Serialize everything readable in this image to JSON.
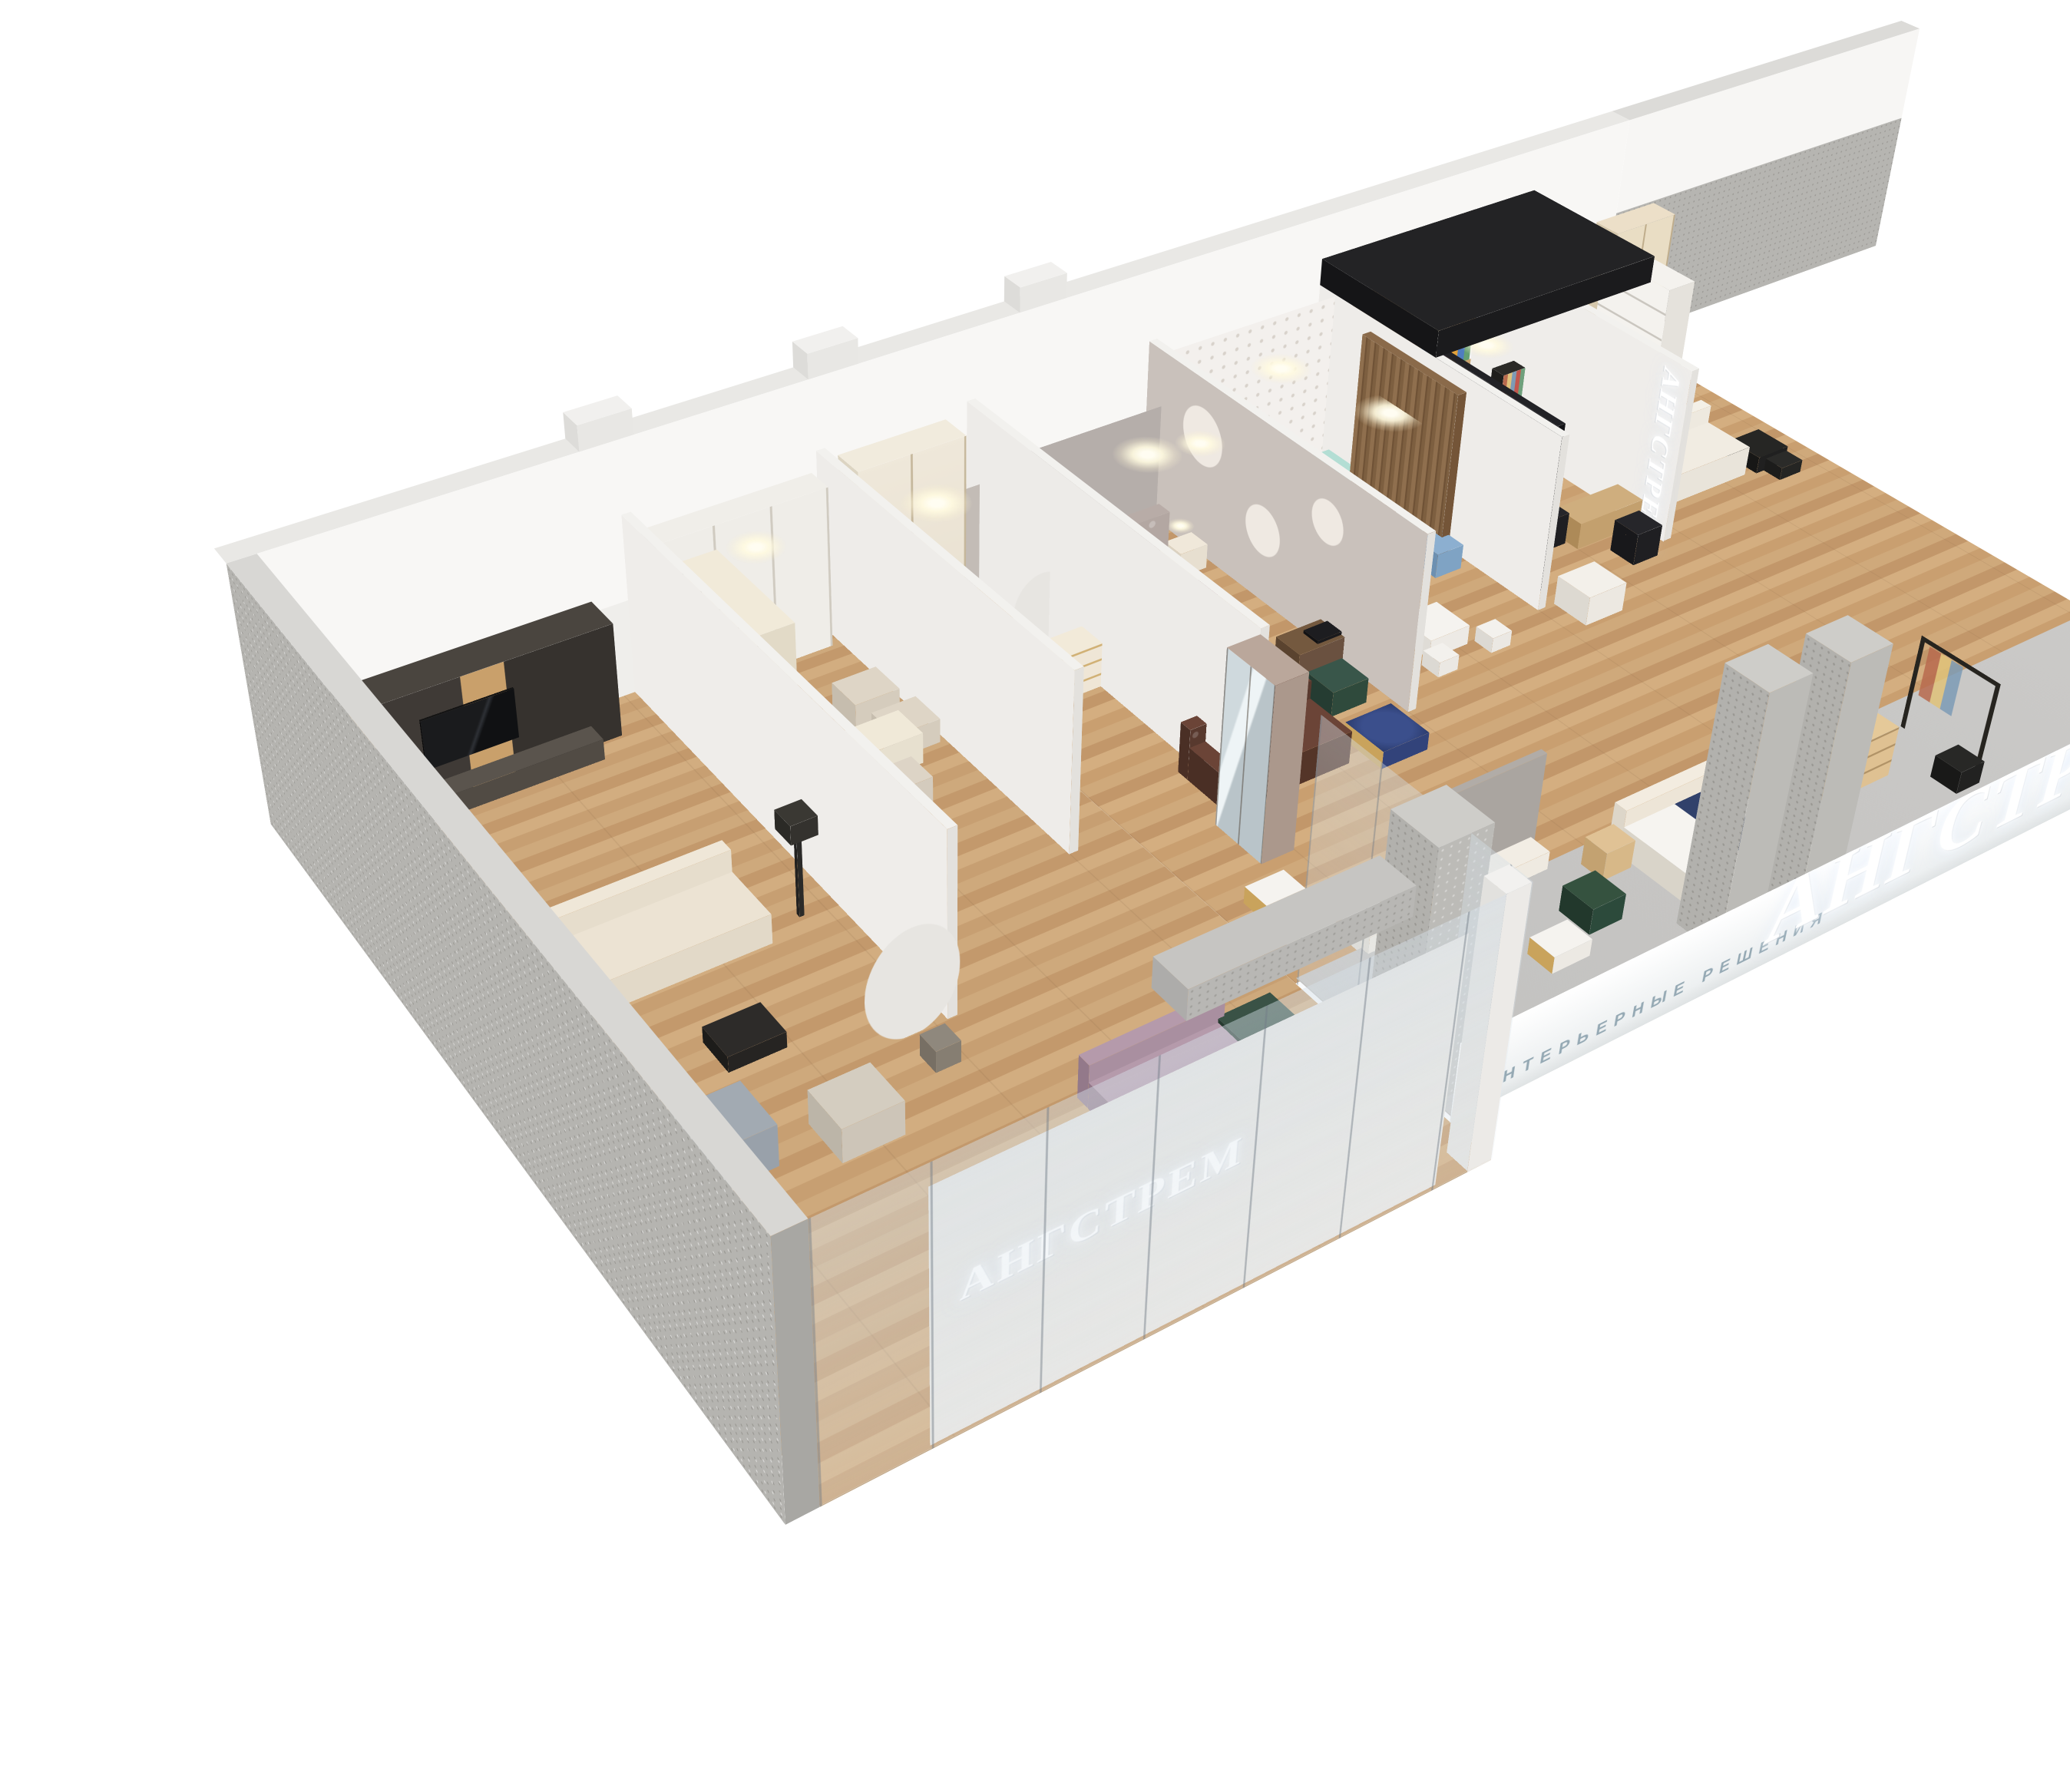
{
  "brand": {
    "name": "АНГСТРЕМ",
    "tagline": "ИНТЕРЬЕРНЫЕ РЕШЕНИЯ"
  },
  "signs": {
    "storefront_glass": "АНГСТРЕМ",
    "fascia_main": "АНГСТРЕМ",
    "fascia_tagline_left": "ИНТЕРЬЕРНЫЕ РЕШЕНИЯ",
    "fascia_tagline_right": "ИНТЕРЬЕРНЫЕ РЕШЕНИЯ",
    "fascia_tagline_far": "ИНТЕРЬЕРНЫЕ РЕШЕНИЯ",
    "interior_vertical_sign": "АНГСТРЕМ",
    "entrance_logo_icon": "angstrem-arrow-logo"
  },
  "palette": {
    "background": "#ffffff",
    "wall_white": "#f4f3f1",
    "concrete": "#b5b4b0",
    "floor_wood": "#c8a478",
    "walkway_slab": "#cbcac8",
    "glass": "rgba(213,225,232,0.28)",
    "tagline_text": "#94a8b3",
    "sign_glow": "#ffffff",
    "sofa_beige": "#e9e1d2",
    "sofa_green": "#31473c",
    "sofa_mauve": "#a98fa0",
    "chesterfield_brown": "#58392e",
    "navy_textile": "#31416b",
    "kids_mint": "#cfe3da",
    "wood_furniture": "#c9a36c",
    "dark_panel": "#1b1b1e",
    "gold": "#c9a35c"
  },
  "scene": {
    "type": "isometric-cutaway-3d-render",
    "subject": "АНГСТРЕМ furniture showroom interior",
    "areas": [
      {
        "name": "living-room-display",
        "items": [
          "tv-wall-unit",
          "tv",
          "beige-sofa",
          "floor-lamp",
          "black-nesting-coffee-tables",
          "gray-armchair",
          "patterned-wing-chair",
          "potted-tree",
          "mauve-chaise-sofa",
          "green-corner-sofa",
          "white-chairs",
          "marble-coffee-table"
        ]
      },
      {
        "name": "classic-study-display",
        "items": [
          "white-built-in",
          "glazed-bookcase",
          "writing-desk",
          "upholstered-chairs",
          "side-cabinet"
        ]
      },
      {
        "name": "hallway-display",
        "items": [
          "cream-wardrobe",
          "chest-of-drawers",
          "mirrored-wardrobe",
          "chandelier",
          "potted-plant"
        ]
      },
      {
        "name": "master-bedroom-display",
        "items": [
          "tufted-bed",
          "nightstands-with-lamps",
          "pink-rug",
          "desk-with-laptop",
          "green-armchair",
          "chesterfield-sofa",
          "blue-glass-table",
          "tv-panel",
          "media-console",
          "circle-mirror-wall"
        ]
      },
      {
        "name": "kids-room-display",
        "items": [
          "mint-bed",
          "teal-bed",
          "mint-desk",
          "blue-chair",
          "orange-pouf",
          "round-kids-table",
          "polka-dot-wall",
          "slat-screen-with-pendant"
        ]
      },
      {
        "name": "office-display",
        "items": [
          "black-glass-partition",
          "wood-bookcase-with-books",
          "wood-desks",
          "black-chairs",
          "fabric-sample-rack",
          "white-armchair",
          "dark-ceiling-bulkhead"
        ]
      },
      {
        "name": "entrance-lounge",
        "items": [
          "dark-wall-with-logo",
          "white-sofa",
          "black-side-tables",
          "potted-plant",
          "shelf-tower",
          "cream-wardrobe"
        ]
      },
      {
        "name": "mall-walkway-display",
        "items": [
          "bed-with-navy-throw",
          "wood-nightstands",
          "wood-dresser",
          "black-clothes-rack",
          "green-tub-chair",
          "marble-coffee-table"
        ]
      }
    ]
  }
}
